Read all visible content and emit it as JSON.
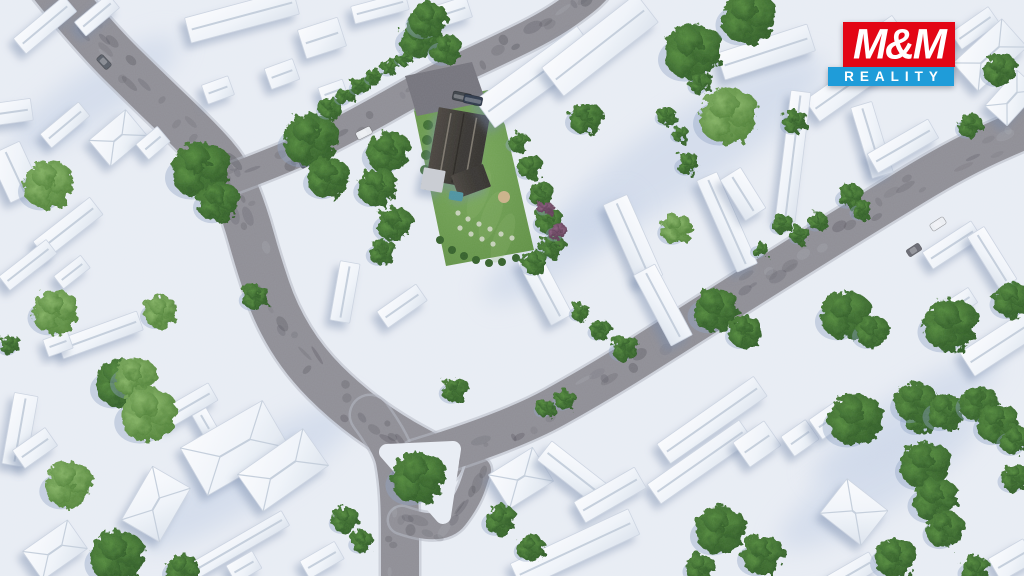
{
  "logo": {
    "line1": "M&M",
    "line2": "REALITY",
    "red": "#e30615",
    "blue": "#1f9cd9",
    "text_color": "#ffffff",
    "box": {
      "left": 828,
      "top": 22,
      "red_left": 15,
      "red_w": 112,
      "red_h": 45,
      "blue_w": 126,
      "blue_h": 19
    }
  },
  "palette": {
    "ground": "#e9edf4",
    "ground_shade": "#c5d1e6",
    "road": "#8f8e95",
    "road_dark": "#45444c",
    "road_light": "#b7bbc4",
    "curb": "#b4b8c2",
    "building_hi": "#fafbfd",
    "building_lo": "#dde4ee",
    "building_edge": "#ccd4e1",
    "ridge": "#c4cedb",
    "shadow": "#7487a8",
    "tree_dark_hi": "#548a3c",
    "tree_dark_lo": "#2e5a25",
    "tree_light_hi": "#85b364",
    "tree_light_lo": "#4e7f35",
    "tree_purple_hi": "#8a5e7d",
    "tree_purple_lo": "#5c3a52",
    "lawn_hi": "#79a85a",
    "lawn_lo": "#5f8f43",
    "roof_hi": "#4a453f",
    "roof_lo": "#35322e",
    "roof_ridge": "#7d776d",
    "garage": "#c9ccd2",
    "driveway": "#75747c",
    "pool": "#4e93a0",
    "sand": "#cbb289",
    "stone": "#cfd6c4"
  },
  "scene": {
    "width": 1024,
    "height": 576,
    "roads": [
      {
        "id": "road-main-north",
        "w": 46,
        "pts": [
          [
            52,
            -15
          ],
          [
            95,
            38
          ],
          [
            150,
            92
          ],
          [
            200,
            140
          ],
          [
            228,
            172
          ],
          [
            245,
            215
          ],
          [
            258,
            262
          ],
          [
            276,
            315
          ],
          [
            305,
            362
          ],
          [
            345,
            402
          ],
          [
            390,
            435
          ],
          [
            440,
            462
          ]
        ]
      },
      {
        "id": "road-south-exit",
        "w": 38,
        "pts": [
          [
            370,
            415
          ],
          [
            392,
            445
          ],
          [
            398,
            478
          ],
          [
            400,
            512
          ],
          [
            400,
            545
          ],
          [
            400,
            585
          ]
        ]
      },
      {
        "id": "road-island-link",
        "w": 26,
        "pts": [
          [
            402,
            520
          ],
          [
            442,
            534
          ],
          [
            468,
            500
          ],
          [
            478,
            470
          ]
        ]
      },
      {
        "id": "road-northeast",
        "w": 40,
        "pts": [
          [
            418,
            460
          ],
          [
            510,
            432
          ],
          [
            600,
            382
          ],
          [
            690,
            325
          ],
          [
            780,
            268
          ],
          [
            870,
            212
          ],
          [
            960,
            157
          ],
          [
            1040,
            122
          ]
        ]
      },
      {
        "id": "road-top",
        "w": 30,
        "pts": [
          [
            228,
            180
          ],
          [
            295,
            155
          ],
          [
            360,
            122
          ],
          [
            430,
            82
          ],
          [
            495,
            52
          ],
          [
            550,
            25
          ],
          [
            585,
            0
          ],
          [
            595,
            -10
          ]
        ]
      }
    ],
    "island": {
      "pts": [
        [
          387,
          452
        ],
        [
          453,
          449
        ],
        [
          443,
          516
        ]
      ]
    },
    "shade_bands": [
      [
        690,
        150,
        160,
        38
      ],
      [
        250,
        475,
        130,
        30
      ],
      [
        880,
        480,
        120,
        30
      ],
      [
        95,
        95,
        100,
        26
      ],
      [
        560,
        250,
        90,
        24
      ],
      [
        905,
        420,
        110,
        26
      ]
    ],
    "property": {
      "lawn": [
        [
          413,
          106
        ],
        [
          488,
          90
        ],
        [
          505,
          125
        ],
        [
          534,
          250
        ],
        [
          446,
          266
        ]
      ],
      "driveway": [
        [
          405,
          76
        ],
        [
          472,
          62
        ],
        [
          486,
          102
        ],
        [
          417,
          116
        ]
      ],
      "house": {
        "cx": 458,
        "cy": 148,
        "w": 52,
        "len": 74,
        "rot": 10
      },
      "wing": {
        "cx": 471,
        "cy": 181,
        "w": 34,
        "h": 24,
        "rot": -20
      },
      "garage": {
        "cx": 433,
        "cy": 180,
        "w": 22,
        "h": 22,
        "rot": 10
      },
      "pool": {
        "cx": 456,
        "cy": 196,
        "w": 14,
        "h": 9,
        "rot": 10
      },
      "sandpit": {
        "cx": 504,
        "cy": 197,
        "r": 6
      },
      "stones": [
        [
          458,
          213
        ],
        [
          468,
          219
        ],
        [
          479,
          224
        ],
        [
          490,
          229
        ],
        [
          501,
          234
        ],
        [
          512,
          238
        ],
        [
          460,
          228
        ],
        [
          471,
          234
        ],
        [
          482,
          239
        ],
        [
          493,
          244
        ]
      ],
      "lawn_bushes": [
        [
          452,
          250
        ],
        [
          464,
          256
        ],
        [
          476,
          260
        ],
        [
          489,
          263
        ],
        [
          502,
          262
        ],
        [
          516,
          258
        ],
        [
          440,
          240
        ],
        [
          476,
          102
        ]
      ],
      "hedge": [
        [
          428,
          125
        ],
        [
          427,
          140
        ],
        [
          426,
          155
        ],
        [
          425,
          170
        ],
        [
          426,
          185
        ]
      ]
    },
    "buildings": [
      [
        45,
        25,
        66,
        20,
        -40
      ],
      [
        97,
        15,
        44,
        18,
        -40
      ],
      [
        242,
        16,
        112,
        26,
        -15
      ],
      [
        380,
        8,
        56,
        18,
        -15
      ],
      [
        322,
        38,
        42,
        30,
        -18
      ],
      [
        452,
        12,
        36,
        22,
        -18
      ],
      [
        218,
        90,
        28,
        20,
        -20
      ],
      [
        282,
        74,
        30,
        22,
        -20
      ],
      [
        333,
        92,
        26,
        18,
        -20
      ],
      [
        12,
        112,
        40,
        22,
        -8
      ],
      [
        65,
        125,
        50,
        18,
        -40
      ],
      [
        118,
        138,
        48,
        34,
        -40,
        "hip"
      ],
      [
        153,
        143,
        28,
        20,
        -40
      ],
      [
        15,
        172,
        34,
        52,
        -25
      ],
      [
        68,
        228,
        72,
        22,
        -38
      ],
      [
        28,
        265,
        60,
        18,
        -38
      ],
      [
        72,
        272,
        34,
        16,
        -38
      ],
      [
        100,
        335,
        85,
        20,
        -20
      ],
      [
        58,
        344,
        26,
        18,
        -20
      ],
      [
        20,
        430,
        24,
        72,
        10
      ],
      [
        188,
        406,
        58,
        20,
        -30
      ],
      [
        205,
        422,
        24,
        16,
        60
      ],
      [
        235,
        448,
        95,
        55,
        -30,
        "hip"
      ],
      [
        283,
        470,
        80,
        45,
        -35,
        "hip"
      ],
      [
        230,
        550,
        128,
        17,
        -30
      ],
      [
        244,
        567,
        30,
        20,
        -30
      ],
      [
        322,
        560,
        40,
        20,
        -30
      ],
      [
        156,
        504,
        44,
        62,
        30,
        "hip"
      ],
      [
        35,
        448,
        40,
        22,
        -35
      ],
      [
        55,
        550,
        55,
        35,
        -35,
        "hip"
      ],
      [
        345,
        292,
        20,
        60,
        10
      ],
      [
        402,
        306,
        48,
        20,
        -35
      ],
      [
        536,
        77,
        126,
        34,
        -36
      ],
      [
        600,
        45,
        120,
        36,
        -38
      ],
      [
        766,
        52,
        95,
        28,
        -18
      ],
      [
        845,
        88,
        80,
        26,
        -35
      ],
      [
        886,
        33,
        30,
        22,
        -35
      ],
      [
        975,
        28,
        46,
        20,
        -35
      ],
      [
        990,
        55,
        66,
        38,
        -42,
        "hip"
      ],
      [
        1012,
        98,
        48,
        30,
        -48,
        "hip"
      ],
      [
        872,
        140,
        22,
        74,
        -17
      ],
      [
        903,
        146,
        70,
        22,
        -30
      ],
      [
        793,
        156,
        20,
        130,
        7
      ],
      [
        727,
        222,
        100,
        22,
        66
      ],
      [
        743,
        194,
        48,
        24,
        58
      ],
      [
        633,
        240,
        88,
        26,
        66
      ],
      [
        663,
        305,
        80,
        24,
        62
      ],
      [
        545,
        288,
        72,
        24,
        62
      ],
      [
        952,
        245,
        58,
        20,
        -33
      ],
      [
        992,
        258,
        62,
        20,
        58
      ],
      [
        1005,
        340,
        90,
        28,
        -33
      ],
      [
        962,
        302,
        26,
        18,
        -33
      ],
      [
        712,
        420,
        118,
        24,
        -35
      ],
      [
        700,
        462,
        112,
        24,
        -35
      ],
      [
        757,
        444,
        38,
        30,
        -35
      ],
      [
        800,
        438,
        30,
        24,
        -35
      ],
      [
        828,
        421,
        30,
        24,
        -35
      ],
      [
        854,
        512,
        52,
        44,
        38,
        "hip"
      ],
      [
        521,
        478,
        52,
        40,
        -32,
        "hip"
      ],
      [
        572,
        472,
        70,
        24,
        38
      ],
      [
        610,
        495,
        70,
        24,
        -30
      ],
      [
        575,
        549,
        130,
        28,
        -25
      ],
      [
        852,
        573,
        50,
        20,
        -30
      ],
      [
        1012,
        560,
        40,
        26,
        -30
      ]
    ],
    "trees": [
      [
        48,
        185,
        24,
        "l"
      ],
      [
        55,
        312,
        22,
        "l"
      ],
      [
        160,
        312,
        16,
        "l"
      ],
      [
        10,
        345,
        10,
        "d"
      ],
      [
        68,
        485,
        23,
        "l"
      ],
      [
        117,
        557,
        26,
        "d"
      ],
      [
        120,
        383,
        24,
        "d"
      ],
      [
        135,
        378,
        20,
        "l"
      ],
      [
        148,
        415,
        27,
        "l"
      ],
      [
        182,
        570,
        16,
        "d"
      ],
      [
        345,
        520,
        13,
        "d"
      ],
      [
        362,
        542,
        11,
        "d"
      ],
      [
        200,
        170,
        28,
        "d"
      ],
      [
        218,
        202,
        20,
        "d"
      ],
      [
        310,
        140,
        26,
        "d"
      ],
      [
        328,
        178,
        20,
        "d"
      ],
      [
        255,
        297,
        13,
        "d"
      ],
      [
        418,
        478,
        26,
        "d"
      ],
      [
        455,
        390,
        13,
        "d"
      ],
      [
        500,
        520,
        15,
        "d"
      ],
      [
        530,
        548,
        13,
        "d"
      ],
      [
        420,
        38,
        20,
        "d"
      ],
      [
        446,
        50,
        15,
        "d"
      ],
      [
        428,
        20,
        18,
        "d"
      ],
      [
        388,
        152,
        21,
        "d"
      ],
      [
        377,
        187,
        19,
        "d"
      ],
      [
        394,
        224,
        17,
        "d"
      ],
      [
        382,
        252,
        13,
        "d"
      ],
      [
        330,
        108,
        11,
        "d"
      ],
      [
        345,
        96,
        9,
        "d"
      ],
      [
        360,
        86,
        9,
        "d"
      ],
      [
        374,
        77,
        8,
        "d"
      ],
      [
        390,
        67,
        9,
        "d"
      ],
      [
        404,
        58,
        8,
        "d"
      ],
      [
        518,
        142,
        10,
        "d"
      ],
      [
        530,
        167,
        12,
        "d"
      ],
      [
        541,
        194,
        12,
        "d"
      ],
      [
        549,
        221,
        13,
        "d"
      ],
      [
        552,
        246,
        12,
        "d"
      ],
      [
        535,
        263,
        12,
        "d"
      ],
      [
        557,
        232,
        9,
        "p"
      ],
      [
        545,
        208,
        7,
        "p"
      ],
      [
        585,
        118,
        16,
        "d"
      ],
      [
        666,
        116,
        9,
        "d"
      ],
      [
        680,
        134,
        8,
        "d"
      ],
      [
        693,
        52,
        28,
        "d"
      ],
      [
        748,
        18,
        26,
        "d"
      ],
      [
        700,
        84,
        10,
        "d"
      ],
      [
        728,
        116,
        28,
        "l"
      ],
      [
        676,
        229,
        15,
        "l"
      ],
      [
        688,
        164,
        11,
        "d"
      ],
      [
        782,
        224,
        10,
        "d"
      ],
      [
        800,
        235,
        9,
        "d"
      ],
      [
        818,
        222,
        9,
        "d"
      ],
      [
        760,
        250,
        8,
        "d"
      ],
      [
        850,
        196,
        12,
        "d"
      ],
      [
        862,
        210,
        10,
        "d"
      ],
      [
        1000,
        70,
        16,
        "d"
      ],
      [
        970,
        126,
        12,
        "d"
      ],
      [
        795,
        122,
        12,
        "d"
      ],
      [
        715,
        310,
        22,
        "d"
      ],
      [
        745,
        332,
        16,
        "d"
      ],
      [
        845,
        315,
        24,
        "d"
      ],
      [
        872,
        332,
        16,
        "d"
      ],
      [
        950,
        325,
        26,
        "d"
      ],
      [
        1012,
        300,
        18,
        "d"
      ],
      [
        625,
        348,
        13,
        "d"
      ],
      [
        565,
        400,
        10,
        "d"
      ],
      [
        545,
        408,
        9,
        "d"
      ],
      [
        600,
        330,
        10,
        "d"
      ],
      [
        580,
        312,
        9,
        "d"
      ],
      [
        920,
        418,
        16,
        "d"
      ],
      [
        855,
        420,
        26,
        "d"
      ],
      [
        915,
        402,
        20,
        "d"
      ],
      [
        945,
        412,
        18,
        "d"
      ],
      [
        978,
        403,
        18,
        "d"
      ],
      [
        998,
        424,
        20,
        "d"
      ],
      [
        925,
        465,
        24,
        "d"
      ],
      [
        935,
        500,
        22,
        "d"
      ],
      [
        895,
        558,
        20,
        "d"
      ],
      [
        945,
        530,
        18,
        "d"
      ],
      [
        1015,
        478,
        14,
        "d"
      ],
      [
        975,
        570,
        14,
        "d"
      ],
      [
        720,
        530,
        24,
        "d"
      ],
      [
        762,
        555,
        20,
        "d"
      ],
      [
        700,
        568,
        14,
        "d"
      ],
      [
        1015,
        440,
        15,
        "d"
      ]
    ],
    "cars": [
      [
        462,
        97,
        9,
        19,
        -78,
        "#3d4248"
      ],
      [
        473,
        100,
        9,
        19,
        -78,
        "#2f3a4c"
      ],
      [
        364,
        133,
        16,
        8,
        -27,
        "#e9ebef"
      ],
      [
        307,
        162,
        15,
        8,
        -27,
        "#51525a"
      ],
      [
        938,
        224,
        16,
        8,
        -33,
        "#edeff3"
      ],
      [
        914,
        250,
        15,
        8,
        -33,
        "#696a72"
      ],
      [
        104,
        62,
        15,
        8,
        47,
        "#5a5f68"
      ]
    ]
  }
}
